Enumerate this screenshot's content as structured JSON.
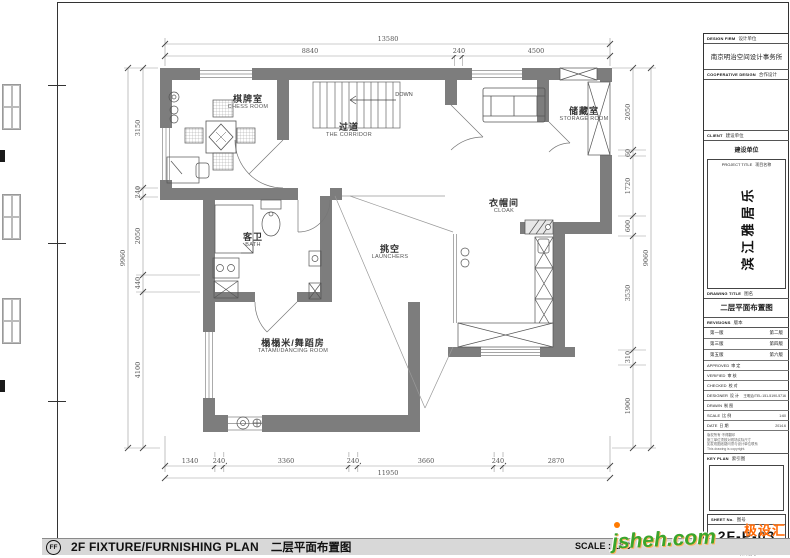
{
  "sheet": {
    "bar": {
      "bubble": "FF",
      "title_en": "2F FIXTURE/FURNISHING PLAN",
      "title_cn": "二层平面布置图",
      "scale": "SCALE : 1/60"
    },
    "watermark": {
      "brand": "极设汇",
      "site": "jsheh.com"
    }
  },
  "plan": {
    "rooms": {
      "chess": {
        "cn": "棋牌室",
        "en": "CHESS ROOM"
      },
      "corridor": {
        "cn": "过道",
        "en": "THE CORRIDOR"
      },
      "storage": {
        "cn": "储藏室",
        "en": "STORAGE ROOM"
      },
      "cloak": {
        "cn": "衣帽间",
        "en": "CLOAK"
      },
      "bath": {
        "cn": "客卫",
        "en": "BATH"
      },
      "void": {
        "cn": "挑空",
        "en": "LAUNCHERS"
      },
      "tatami": {
        "cn": "榻榻米/舞蹈房",
        "en": "TATAMI/DANCING  ROOM"
      }
    },
    "stairs": {
      "down": "DOWN"
    },
    "dims": {
      "top": {
        "overall": "13580",
        "segments": [
          "8840",
          "240",
          "4500"
        ]
      },
      "bottom": {
        "overall": "11950",
        "segments": [
          "1340",
          "240",
          "3360",
          "240",
          "3660",
          "240",
          "2870"
        ]
      },
      "left": {
        "overall": "9960",
        "segments": [
          "3150",
          "240",
          "2050",
          "440",
          "4100"
        ]
      },
      "right": {
        "overall": "9060",
        "segments": [
          "2050",
          "60",
          "1720",
          "600",
          "3530",
          "310",
          "1900"
        ]
      }
    }
  },
  "title_block": {
    "design_firm": {
      "en": "DESIGN FIRM",
      "cn": "设计单位",
      "value": "南京明治空间设计事务所"
    },
    "coop": {
      "en": "COOPERATIVE DESIGN",
      "cn": "合作设计"
    },
    "client": {
      "en": "CLIENT",
      "cn": "建设单位",
      "value": "建设单位"
    },
    "project_title": {
      "en": "PROJECT TITLE",
      "cn": "项目名称",
      "value": "滨江雅居乐"
    },
    "drawing_title": {
      "en": "DRAWING TITLE",
      "cn": "图名",
      "value": "二层平面布置图"
    },
    "revisions": {
      "en": "REVISIONS",
      "cn": "版本",
      "rows": [
        [
          "第一版",
          "第二版"
        ],
        [
          "第三版",
          "第四版"
        ],
        [
          "第五版",
          "第六版"
        ]
      ]
    },
    "rows": [
      {
        "en": "APPROVED",
        "cn": "审 定",
        "value": ""
      },
      {
        "en": "VERIFIED",
        "cn": "审 核",
        "value": ""
      },
      {
        "en": "CHECKED",
        "cn": "校 对",
        "value": ""
      },
      {
        "en": "DESIGNER",
        "cn": "设 计",
        "value": "王明治/TEL:151-5190-5716"
      },
      {
        "en": "DRAWN",
        "cn": "制 图",
        "value": ""
      },
      {
        "en": "SCALE",
        "cn": "比 例",
        "value": "1:60"
      },
      {
        "en": "DATE",
        "cn": "日 期",
        "value": "2014.6"
      }
    ],
    "copyright_lines": [
      "版权所有·不得翻印",
      "施工单位须核对现场实际尺寸",
      "如发现图纸疑问须与设计单位联系",
      "This drawing is copyright."
    ],
    "key_plan": {
      "en": "KEY PLAN",
      "cn": "索引图"
    },
    "sheet_no": {
      "en": "SHEET No.",
      "cn": "图号",
      "value": "2F-P-03"
    },
    "project_no": {
      "en": "PROJECT No.",
      "cn": "项目编号"
    }
  }
}
